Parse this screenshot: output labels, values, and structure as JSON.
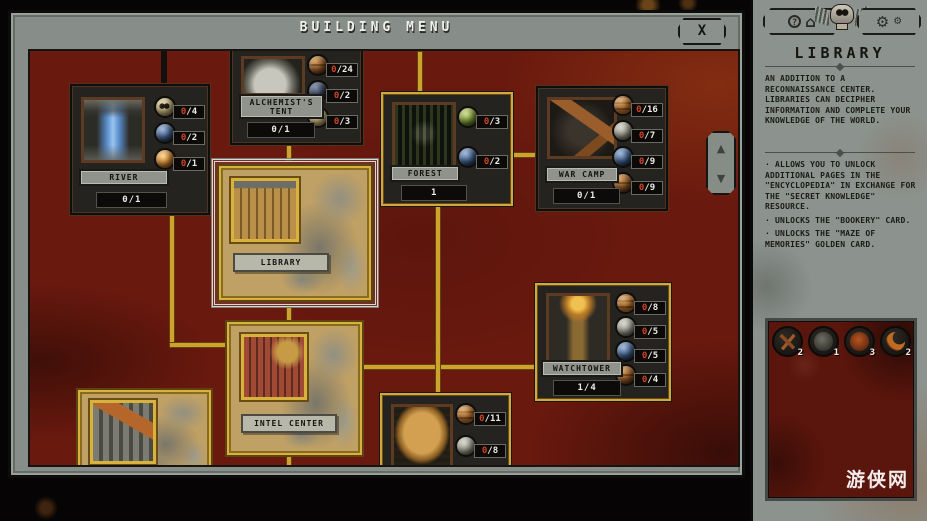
{
  "window": {
    "title": "BUILDING MENU",
    "close": "X"
  },
  "scroll": {
    "up": "▲",
    "down": "▼"
  },
  "cards": [
    {
      "name": "RIVER",
      "count": "0/1",
      "state": "locked",
      "costs": [
        {
          "icon": "skull",
          "num": "0",
          "rest": "/4"
        },
        {
          "icon": "blue-orb",
          "num": "0",
          "rest": "/2"
        },
        {
          "icon": "amber-orb",
          "num": "0",
          "rest": "/1"
        }
      ]
    },
    {
      "name": "ALCHEMIST'S TENT",
      "count": "0/1",
      "state": "locked",
      "costs": [
        {
          "icon": "barrels",
          "num": "0",
          "rest": "/24"
        },
        {
          "icon": "dark-orb",
          "num": "0",
          "rest": "/2"
        },
        {
          "icon": "skull",
          "num": "0",
          "rest": "/3"
        }
      ]
    },
    {
      "name": "FOREST",
      "count": "1",
      "state": "buildable",
      "costs": [
        {
          "icon": "green-swirl",
          "num": "0",
          "rest": "/3"
        },
        {
          "icon": "blue-orb",
          "num": "0",
          "rest": "/2"
        }
      ]
    },
    {
      "name": "WAR CAMP",
      "count": "0/1",
      "state": "locked",
      "costs": [
        {
          "icon": "planks",
          "num": "0",
          "rest": "/16"
        },
        {
          "icon": "stone",
          "num": "0",
          "rest": "/7"
        },
        {
          "icon": "blue-orb",
          "num": "0",
          "rest": "/9"
        },
        {
          "icon": "barrels",
          "num": "0",
          "rest": "/9"
        }
      ]
    },
    {
      "name": "LIBRARY",
      "state": "built-selected"
    },
    {
      "name": "INTEL CENTER",
      "state": "built"
    },
    {
      "name": "WATCHTOWER",
      "count": "1/4",
      "state": "buildable",
      "costs": [
        {
          "icon": "planks",
          "num": "0",
          "rest": "/8"
        },
        {
          "icon": "stone",
          "num": "0",
          "rest": "/5"
        },
        {
          "icon": "blue-orb",
          "num": "0",
          "rest": "/5"
        },
        {
          "icon": "barrels",
          "num": "0",
          "rest": "/4"
        }
      ]
    },
    {
      "name": "",
      "state": "buildable",
      "costs": [
        {
          "icon": "planks",
          "num": "0",
          "rest": "/11"
        },
        {
          "icon": "stone",
          "num": "0",
          "rest": "/8"
        },
        {
          "icon": "blue-orb",
          "num": "",
          "rest": ""
        }
      ]
    },
    {
      "name": "",
      "state": "built"
    }
  ],
  "sidebar": {
    "title": "LIBRARY",
    "help_label": "?",
    "home_icon": "⌂",
    "gear_icon": "⚙",
    "description": "AN ADDITION TO A RECONNAISSANCE CENTER. LIBRARIES CAN DECIPHER INFORMATION AND COMPLETE YOUR KNOWLEDGE OF THE WORLD.",
    "bullets": [
      "· ALLOWS YOU TO UNLOCK ADDITIONAL PAGES IN THE \"ENCYCLOPEDIA\" IN EXCHANGE FOR THE \"SECRET KNOWLEDGE\" RESOURCE.",
      "· UNLOCKS THE \"BOOKERY\" CARD.",
      "· UNLOCKS THE \"MAZE OF MEMORIES\" GOLDEN CARD."
    ],
    "resources": [
      {
        "count": "2"
      },
      {
        "count": "1"
      },
      {
        "count": "3"
      },
      {
        "count": "2"
      }
    ],
    "watermark": "游侠网"
  },
  "colors": {
    "accent_gold": "#cfa22e",
    "board_red": "#6a190e",
    "cost_number_red": "#d04424"
  }
}
